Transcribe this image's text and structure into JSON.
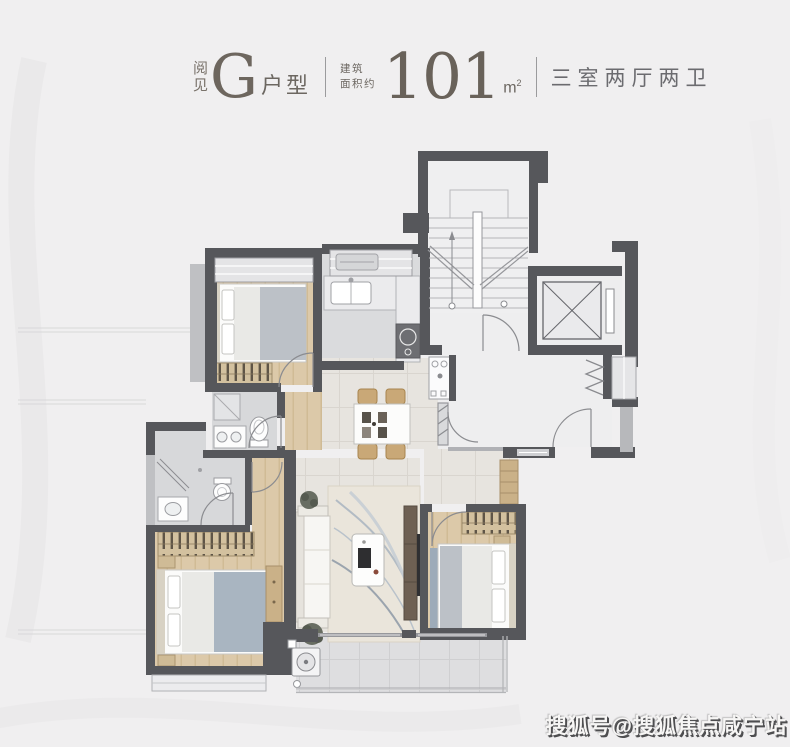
{
  "header": {
    "brand_char_1": "阅",
    "brand_char_2": "见",
    "unit_letter": "G",
    "unit_type_label": "户型",
    "area_label_line1": "建筑",
    "area_label_line2": "面积约",
    "area_value": "101",
    "area_unit_base": "m",
    "area_unit_sup": "2",
    "layout_label": "三室两厅两卫"
  },
  "watermark": {
    "text": "搜狐号@搜狐焦点咸宁站"
  },
  "colors": {
    "background": "#f0eff0",
    "wall": "#56575b",
    "wall_light": "#b9babd",
    "wood_floor": "#dcc9a9",
    "bath_floor": "#d7d8da",
    "living_floor": "#e7e4df",
    "balcony_floor": "#dedee0",
    "accent_blue": "#a9b5c1",
    "furniture_wood": "#cab188",
    "title_text": "#6d665e",
    "watermark_shadow": "#4e4e50"
  }
}
